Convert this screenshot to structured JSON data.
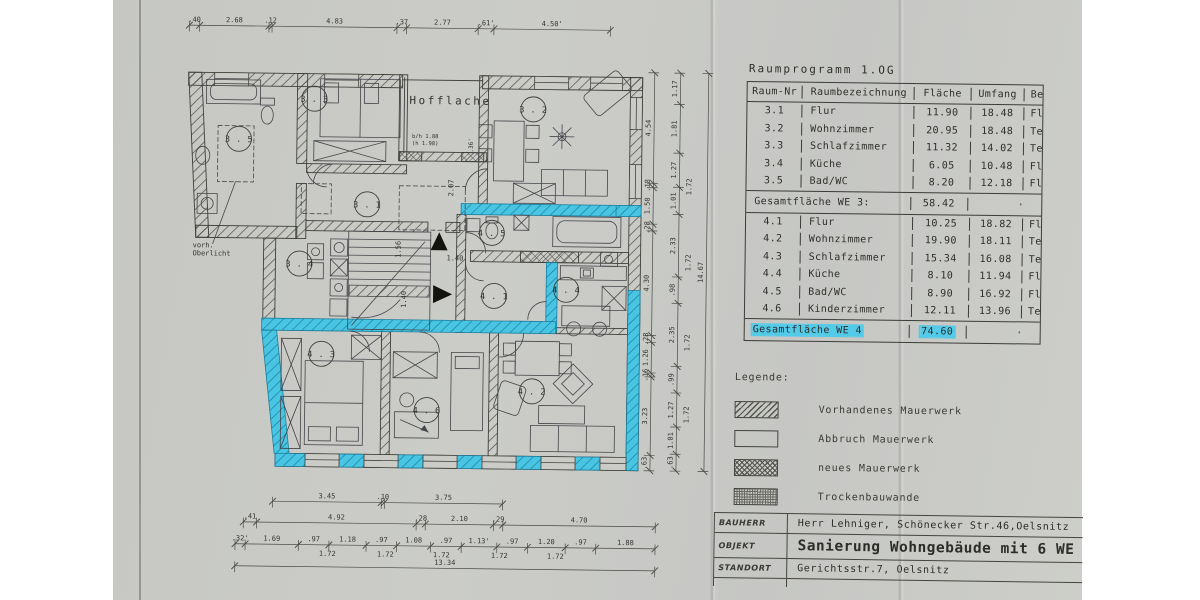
{
  "colors": {
    "paper": "#c8c9c5",
    "highlight": "#52cae8",
    "line": "#3c3c38"
  },
  "room_table": {
    "title": "Raumprogramm 1.OG",
    "columns": [
      "Raum-Nr",
      "Raumbezeichnung",
      "Fläche",
      "Umfang",
      "Belag"
    ],
    "we3_rows": [
      [
        "3.1",
        "Flur",
        "11.90",
        "18.48",
        "Fl."
      ],
      [
        "3.2",
        "Wohnzimmer",
        "20.95",
        "18.48",
        "Text"
      ],
      [
        "3.3",
        "Schlafzimmer",
        "11.32",
        "14.02",
        "Text."
      ],
      [
        "3.4",
        "Küche",
        "6.05",
        "10.48",
        "Fl."
      ],
      [
        "3.5",
        "Bad/WC",
        "8.20",
        "12.18",
        "Fl."
      ]
    ],
    "we3_total": {
      "label": "Gesamtfläche WE 3:",
      "value": "58.42"
    },
    "we4_rows": [
      [
        "4.1",
        "Flur",
        "10.25",
        "18.82",
        "Fl."
      ],
      [
        "4.2",
        "Wohnzimmer",
        "19.90",
        "18.11",
        "Text."
      ],
      [
        "4.3",
        "Schlafzimmer",
        "15.34",
        "16.08",
        "Text."
      ],
      [
        "4.4",
        "Küche",
        "8.10",
        "11.94",
        "Fl."
      ],
      [
        "4.5",
        "Bad/WC",
        "8.90",
        "16.92",
        "Fl."
      ],
      [
        "4.6",
        "Kinderzimmer",
        "12.11",
        "13.96",
        "Text."
      ]
    ],
    "we4_total": {
      "label": "Gesamtfläche WE 4",
      "value": "74.60",
      "highlighted": true
    }
  },
  "legend": {
    "title": "Legende:",
    "items": [
      {
        "swatch": "diag",
        "label": "Vorhandenes Mauerwerk"
      },
      {
        "swatch": "empty",
        "label": "Abbruch Mauerwerk"
      },
      {
        "swatch": "cross",
        "label": "neues Mauerwerk"
      },
      {
        "swatch": "dots",
        "label": "Trockenbauwande"
      }
    ]
  },
  "title_block": {
    "rows": [
      {
        "label": "BAUHERR",
        "value": "Herr Lehniger, Schönecker Str.46,Oelsnitz",
        "big": false
      },
      {
        "label": "OBJEKT",
        "value": "Sanierung Wohngebäude mit 6 WE",
        "big": true
      },
      {
        "label": "STANDORT",
        "value": "Gerichtsstr.7, Oelsnitz",
        "big": false
      }
    ]
  },
  "plan": {
    "rooms": [
      {
        "id": "3.1",
        "x": 366,
        "y": 205
      },
      {
        "id": "3.2",
        "x": 531,
        "y": 108
      },
      {
        "id": "3.3",
        "x": 312,
        "y": 100
      },
      {
        "id": "3.4",
        "x": 299,
        "y": 265
      },
      {
        "id": "3.5",
        "x": 237,
        "y": 141
      },
      {
        "id": "4.1",
        "x": 494,
        "y": 295
      },
      {
        "id": "4.2",
        "x": 533,
        "y": 390
      },
      {
        "id": "4.3",
        "x": 322,
        "y": 355
      },
      {
        "id": "4.4",
        "x": 566,
        "y": 288
      },
      {
        "id": "4.5",
        "x": 491,
        "y": 232
      },
      {
        "id": "4.6",
        "x": 428,
        "y": 410
      }
    ],
    "annotations": [
      {
        "t": "Hofflache",
        "x": 407,
        "y": 104,
        "s": 11,
        "ls": 2.5
      },
      {
        "t": "vorh.",
        "x": 192,
        "y": 250,
        "s": 7
      },
      {
        "t": "Oberlicht",
        "x": 192,
        "y": 258,
        "s": 7
      },
      {
        "t": "b/h 1.88",
        "x": 410,
        "y": 138,
        "s": 5.5
      },
      {
        "t": "(h 1.98)",
        "x": 410,
        "y": 145,
        "s": 5.5
      },
      {
        "t": "1.40",
        "x": 446,
        "y": 260,
        "s": 7
      },
      {
        "t": "1.56",
        "x": 400,
        "y": 258,
        "s": 7,
        "r": -90
      },
      {
        "t": "1.40",
        "x": 406,
        "y": 308,
        "s": 7,
        "r": -90
      },
      {
        "t": "2.07",
        "x": 452,
        "y": 196,
        "s": 7,
        "r": -90
      },
      {
        "t": ".36'",
        "x": 471,
        "y": 152,
        "s": 6,
        "r": -90
      },
      {
        "t": "1.72",
        "x": 322,
        "y": 557,
        "s": 7
      },
      {
        "t": "1.72",
        "x": 380,
        "y": 557,
        "s": 7
      },
      {
        "t": "1.72",
        "x": 436,
        "y": 557,
        "s": 7
      },
      {
        "t": "1.72",
        "x": 494,
        "y": 557,
        "s": 7
      },
      {
        "t": "1.72",
        "x": 550,
        "y": 557,
        "s": 7
      },
      {
        "t": "1.72",
        "x": 690,
        "y": 192,
        "s": 7,
        "r": -90
      },
      {
        "t": "1.72",
        "x": 690,
        "y": 268,
        "s": 7,
        "r": -90
      },
      {
        "t": "1.72",
        "x": 690,
        "y": 348,
        "s": 7,
        "r": -90
      },
      {
        "t": "1.72",
        "x": 690,
        "y": 420,
        "s": 7,
        "r": -90
      }
    ],
    "dims": [
      {
        "dir": "h",
        "x": 186,
        "y": 28,
        "len": 421,
        "values": [
          ".40",
          "2.68",
          ".12",
          "4.83",
          ".37",
          "2.77",
          ".61'",
          "4.50'"
        ]
      },
      {
        "dir": "h",
        "x": 275,
        "y": 503,
        "len": 230,
        "values": [
          "3.45",
          ".10",
          "3.75"
        ]
      },
      {
        "dir": "h",
        "x": 246,
        "y": 524,
        "len": 412,
        "values": [
          ".41",
          "4.92",
          ".28",
          "2.10",
          ".29",
          "4.70"
        ]
      },
      {
        "dir": "h",
        "x": 238,
        "y": 546,
        "len": 420,
        "values": [
          ".32'",
          "1.69",
          ".97",
          "1.18",
          ".97",
          "1.08",
          ".97",
          "1.13'",
          ".97",
          "1.20",
          ".97",
          "1.88"
        ]
      },
      {
        "dir": "h",
        "x": 238,
        "y": 568,
        "len": 420,
        "values": [
          "13.34"
        ]
      },
      {
        "dir": "v",
        "x": 652,
        "y": 70,
        "len": 398,
        "values": [
          "4.54",
          ".18",
          "1.50",
          ".28",
          "4.30",
          ".28",
          "1.26",
          ".16",
          "3.23",
          ".63"
        ]
      },
      {
        "dir": "v",
        "x": 678,
        "y": 70,
        "len": 398,
        "values": [
          "1.17",
          "1.81",
          "1.27",
          "1.01",
          "2.33",
          ".98",
          "2.35",
          ".99",
          "1.27",
          "1.01",
          ".63"
        ]
      },
      {
        "dir": "v",
        "x": 706,
        "y": 70,
        "len": 398,
        "values": [
          "14.67"
        ]
      }
    ]
  }
}
